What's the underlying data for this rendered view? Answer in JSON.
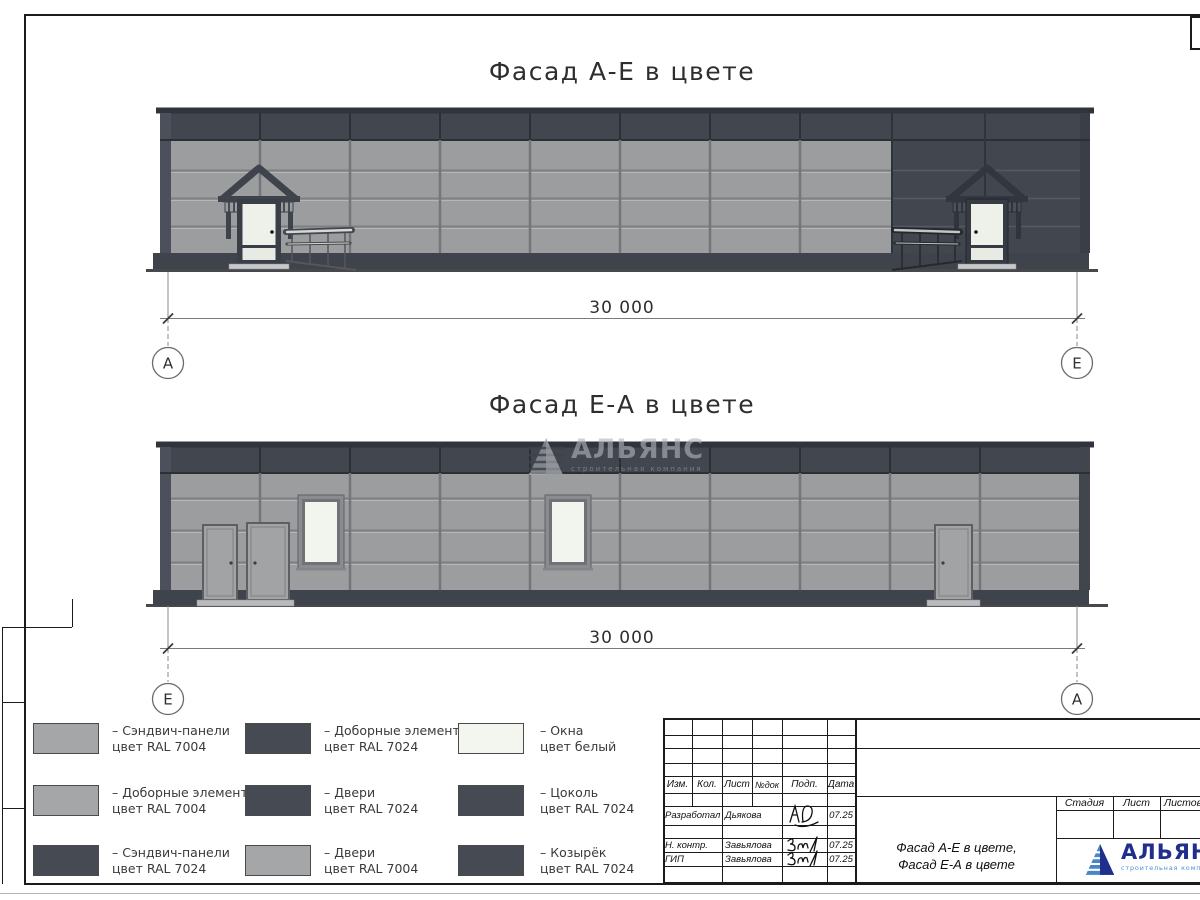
{
  "drawing": {
    "title_top": "Фасад А-Е в цвете",
    "title_bottom": "Фасад Е-А в цвете",
    "dim_top": "30 000",
    "dim_bottom": "30 000",
    "axis_top_left": "А",
    "axis_top_right": "Е",
    "axis_bottom_left": "Е",
    "axis_bottom_right": "А"
  },
  "legend": {
    "items": [
      {
        "label": "– Сэндвич-панели",
        "color_label": "цвет RAL 7004",
        "color": "#a4a6a8"
      },
      {
        "label": "– Доборные элементы",
        "color_label": "цвет RAL 7004",
        "color": "#a4a6a8"
      },
      {
        "label": "– Сэндвич-панели",
        "color_label": "цвет RAL 7024",
        "color": "#454a53"
      },
      {
        "label": "– Доборные элементы",
        "color_label": "цвет RAL 7024",
        "color": "#454a53"
      },
      {
        "label": "– Двери",
        "color_label": "цвет RAL 7024",
        "color": "#454a53"
      },
      {
        "label": "– Двери",
        "color_label": "цвет RAL 7004",
        "color": "#a4a6a8"
      },
      {
        "label": "– Окна",
        "color_label": "цвет белый",
        "color": "#f3f6ee"
      },
      {
        "label": "– Цоколь",
        "color_label": "цвет RAL 7024",
        "color": "#454a53"
      },
      {
        "label": "– Козырёк",
        "color_label": "цвет RAL 7024",
        "color": "#454a53"
      }
    ]
  },
  "titleblock": {
    "cols": {
      "izm": "Изм.",
      "kol": "Кол.",
      "list": "Лист",
      "ndok": "№док",
      "podp": "Подп.",
      "data": "Дата"
    },
    "rows": [
      {
        "role": "Разработал",
        "name": "Дьякова",
        "date": "07.25"
      },
      {
        "role": "Н. контр.",
        "name": "Завьялова",
        "date": "07.25"
      },
      {
        "role": "ГИП",
        "name": "Завьялова",
        "date": "07.25"
      }
    ],
    "stage": "Стадия",
    "sheet": "Лист",
    "sheets": "Листов",
    "doc_title_line1": "Фасад А-Е в цвете,",
    "doc_title_line2": "Фасад Е-А в цвете",
    "logo_name": "АЛЬЯНС",
    "logo_subtitle": "строительная компания"
  },
  "watermark": {
    "name": "АЛЬЯНС",
    "subtitle": "строительная компания"
  },
  "colors": {
    "ral7004": "#a4a6a8",
    "ral7024": "#454a53",
    "window_white": "#f3f6ee",
    "panel_light": "#9b9d9f",
    "band_dark": "#41464f",
    "logo_blue": "#202f8c",
    "logo_light_blue": "#4d92d6"
  }
}
